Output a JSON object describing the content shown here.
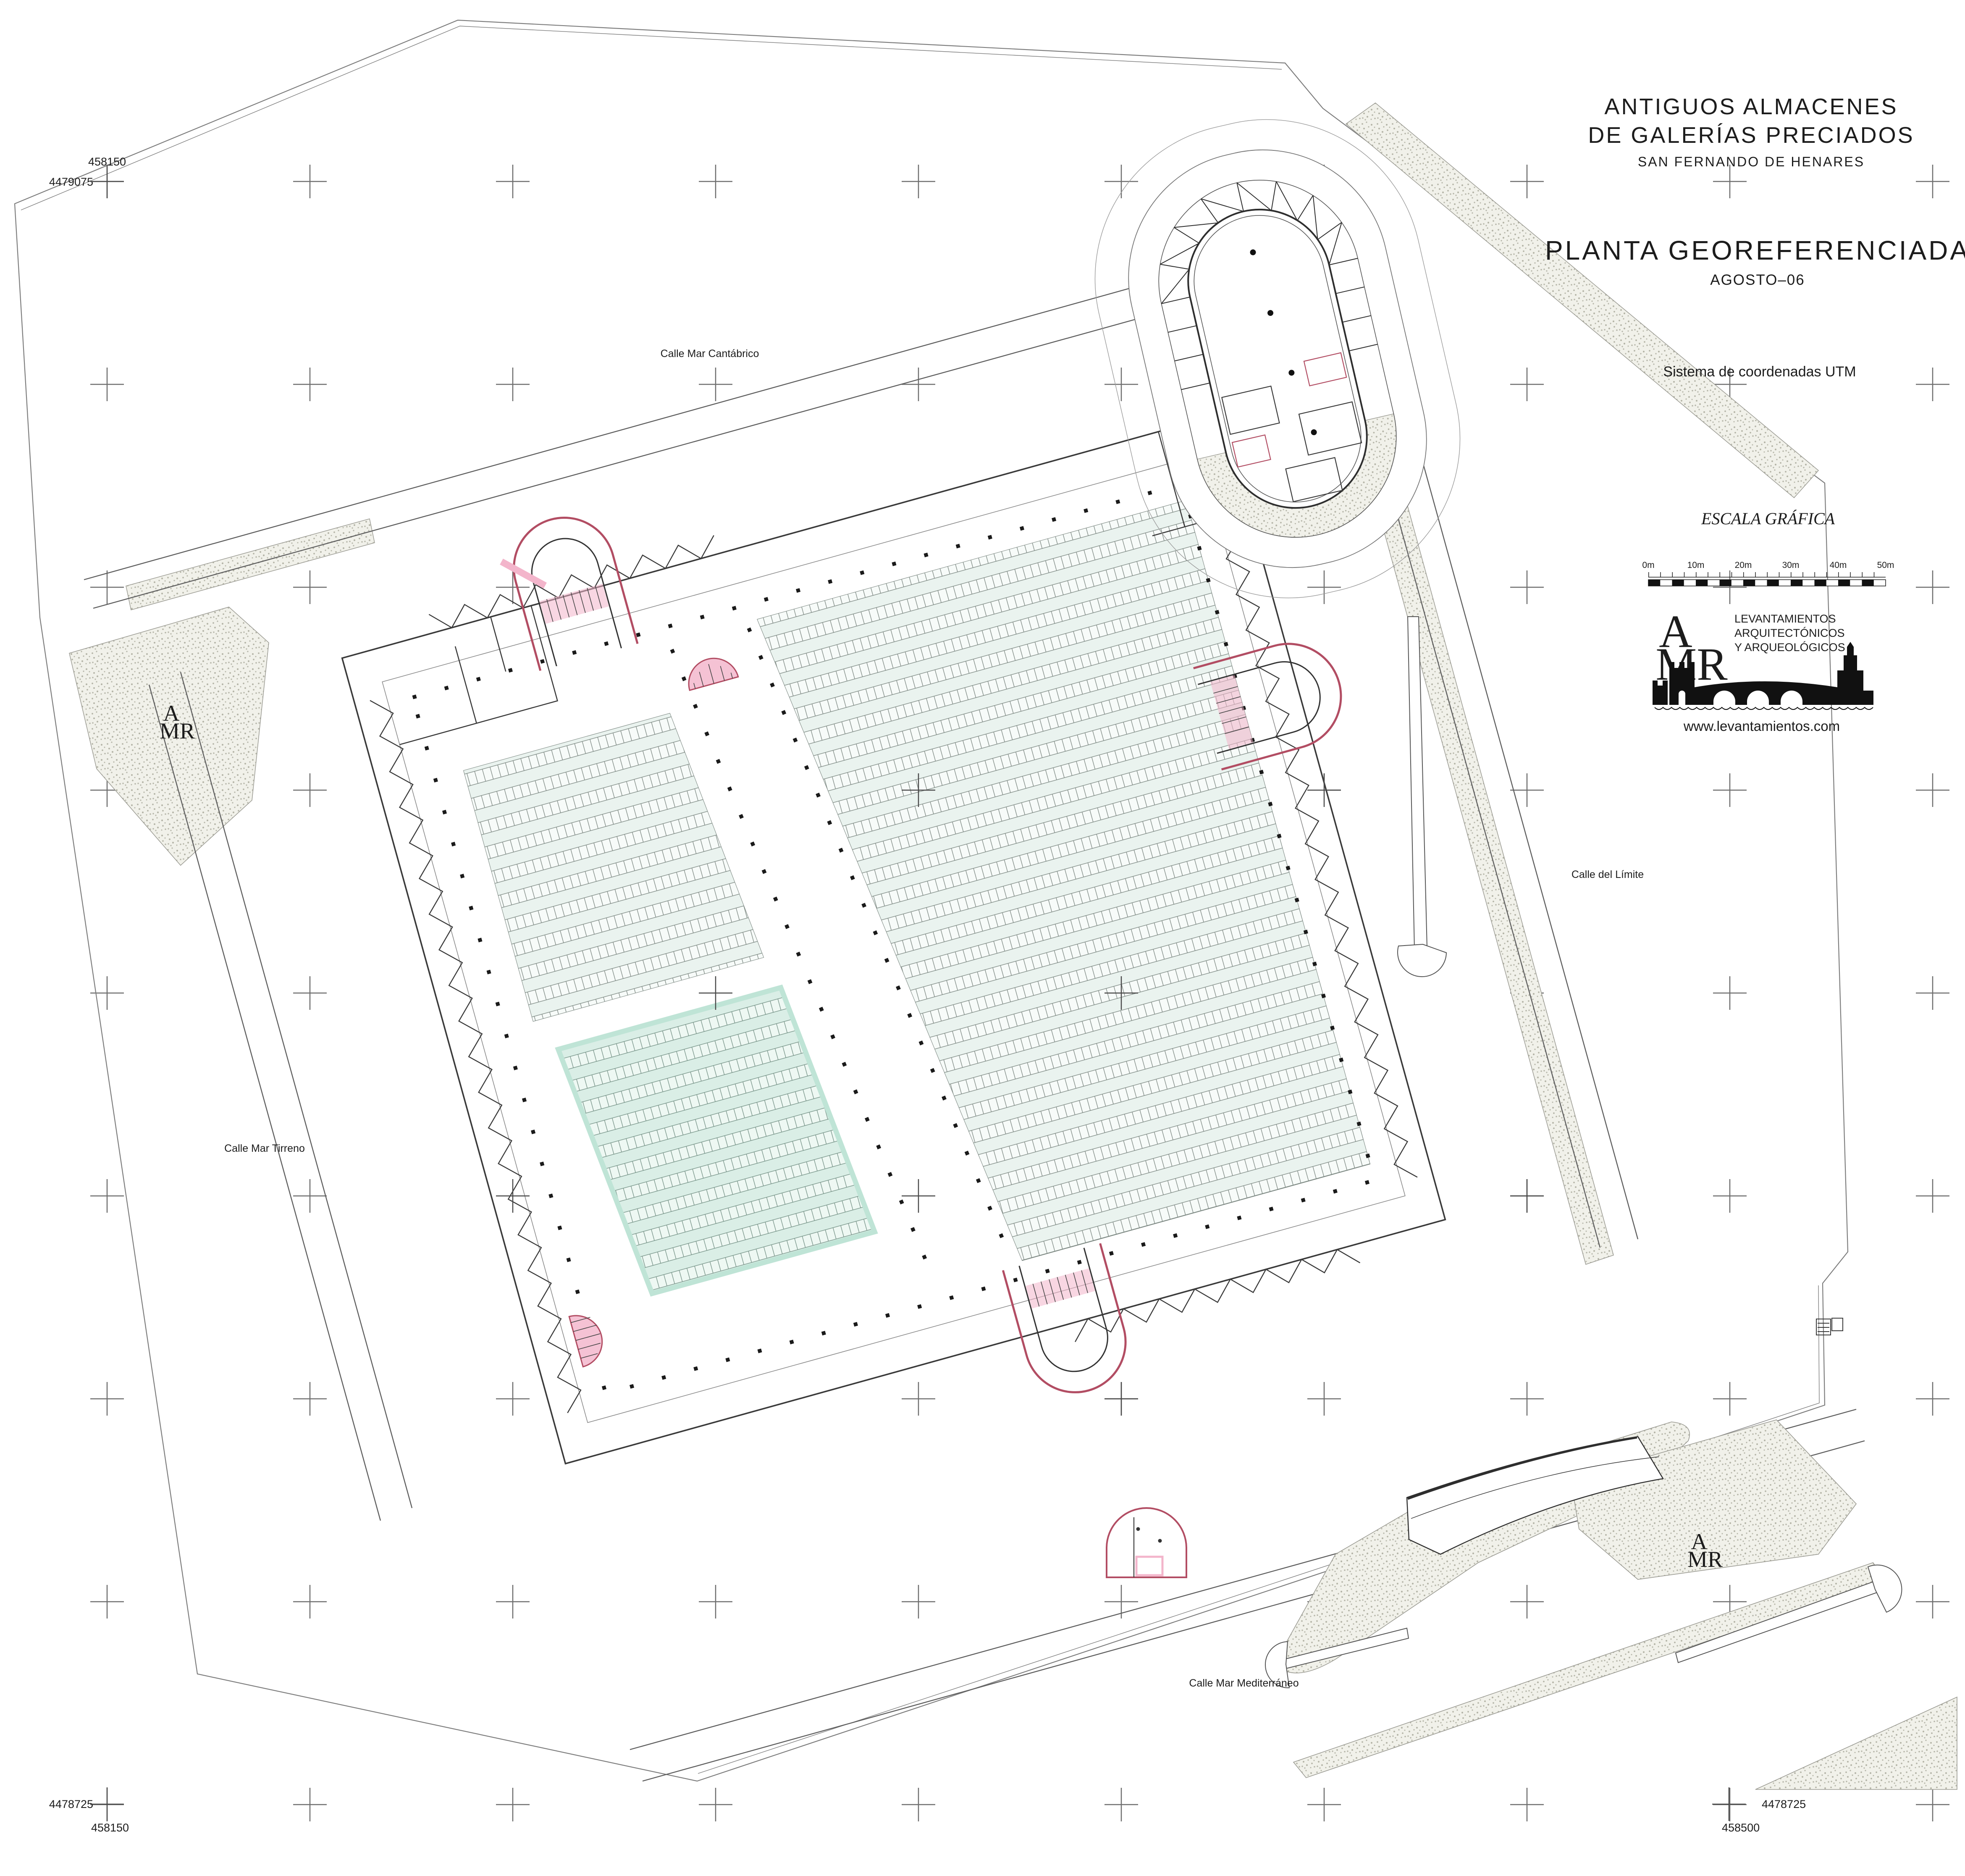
{
  "sheet_title": {
    "line1": "ANTIGUOS  ALMACENES",
    "line2": "DE  GALERÍAS  PRECIADOS",
    "line3": "SAN  FERNANDO  DE  HENARES"
  },
  "drawing": {
    "title": "PLANTA  GEOREFERENCIADA",
    "date": "AGOSTO–06",
    "coordinate_note": "Sistema de coordenadas UTM"
  },
  "scale_bar": {
    "title": "ESCALA GRÁFICA",
    "ticks": [
      "0m",
      "10m",
      "20m",
      "30m",
      "40m",
      "50m"
    ]
  },
  "logo": {
    "monogram_top": "A",
    "monogram_bottom": "MR",
    "line1": "LEVANTAMIENTOS",
    "line2": "ARQUITECTÓNICOS",
    "line3": "Y ARQUEOLÓGICOS",
    "website": "www.levantamientos.com"
  },
  "streets": {
    "north": "Calle Mar Cantábrico",
    "west": "Calle Mar Tirreno",
    "south": "Calle Mar Mediterráneo",
    "east": "Calle del Límite"
  },
  "utm": {
    "top_left_easting": "458150",
    "top_left_northing": "4479075",
    "bottom_left_northing": "4478725",
    "bottom_left_easting": "458150",
    "bottom_right_northing": "4478725",
    "bottom_right_easting": "458500"
  },
  "stamp": {
    "top": "A",
    "bottom": "MR"
  },
  "colors": {
    "accent_pink": "#f3b5cb",
    "accent_crimson": "#b24d63",
    "rack_tint": "#eaf3ef",
    "cyan_tint": "#daeee6",
    "stipple_bg": "#f1f1ea",
    "line": "#3a3a3a"
  }
}
